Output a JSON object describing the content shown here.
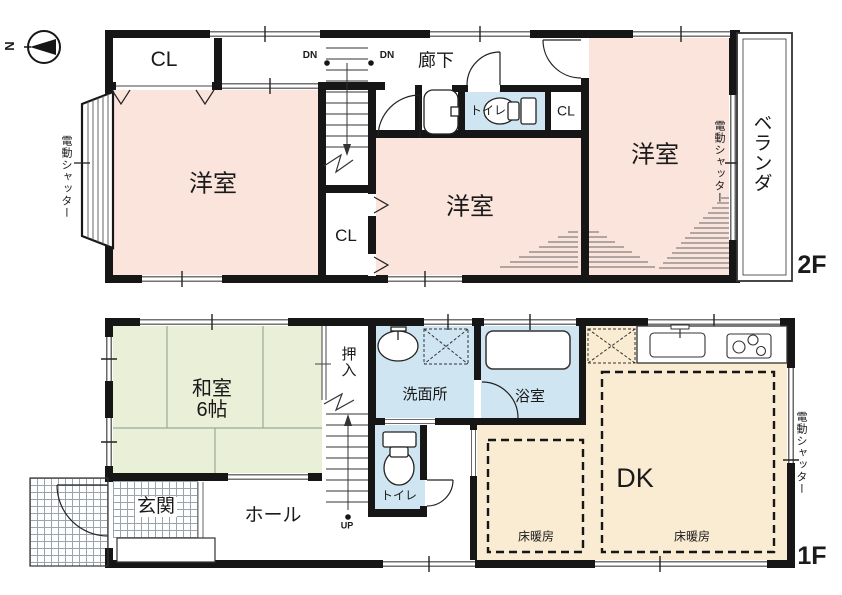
{
  "compass": {
    "north": "N"
  },
  "colors": {
    "wall": "#161616",
    "bedroom_pink": "#fae4dc",
    "tatami_green": "#eaefd8",
    "wet_area_blue": "#cfe6f2",
    "dk_cream": "#faecd2"
  },
  "floor2": {
    "label": "2F",
    "closet_top": "CL",
    "closet_mid": "CL",
    "closet_small": "CL",
    "hallway": "廊下",
    "toilet": "トイレ",
    "bedroom_left": "洋室",
    "bedroom_middle": "洋室",
    "bedroom_right": "洋室",
    "veranda": "ベランダ",
    "shutter_left": "電動シャッター",
    "shutter_right": "電動シャッター",
    "stairs_dn_left": "DN",
    "stairs_dn_right": "DN"
  },
  "floor1": {
    "label": "1F",
    "japanese_room_name": "和室",
    "japanese_room_size": "6帖",
    "closet": "押入",
    "washroom": "洗面所",
    "bathroom": "浴室",
    "toilet": "トイレ",
    "dining_kitchen": "DK",
    "floor_heating_left": "床暖房",
    "floor_heating_right": "床暖房",
    "entrance": "玄関",
    "hall": "ホール",
    "stairs_up": "UP",
    "shutter_right": "電動シャッター"
  }
}
